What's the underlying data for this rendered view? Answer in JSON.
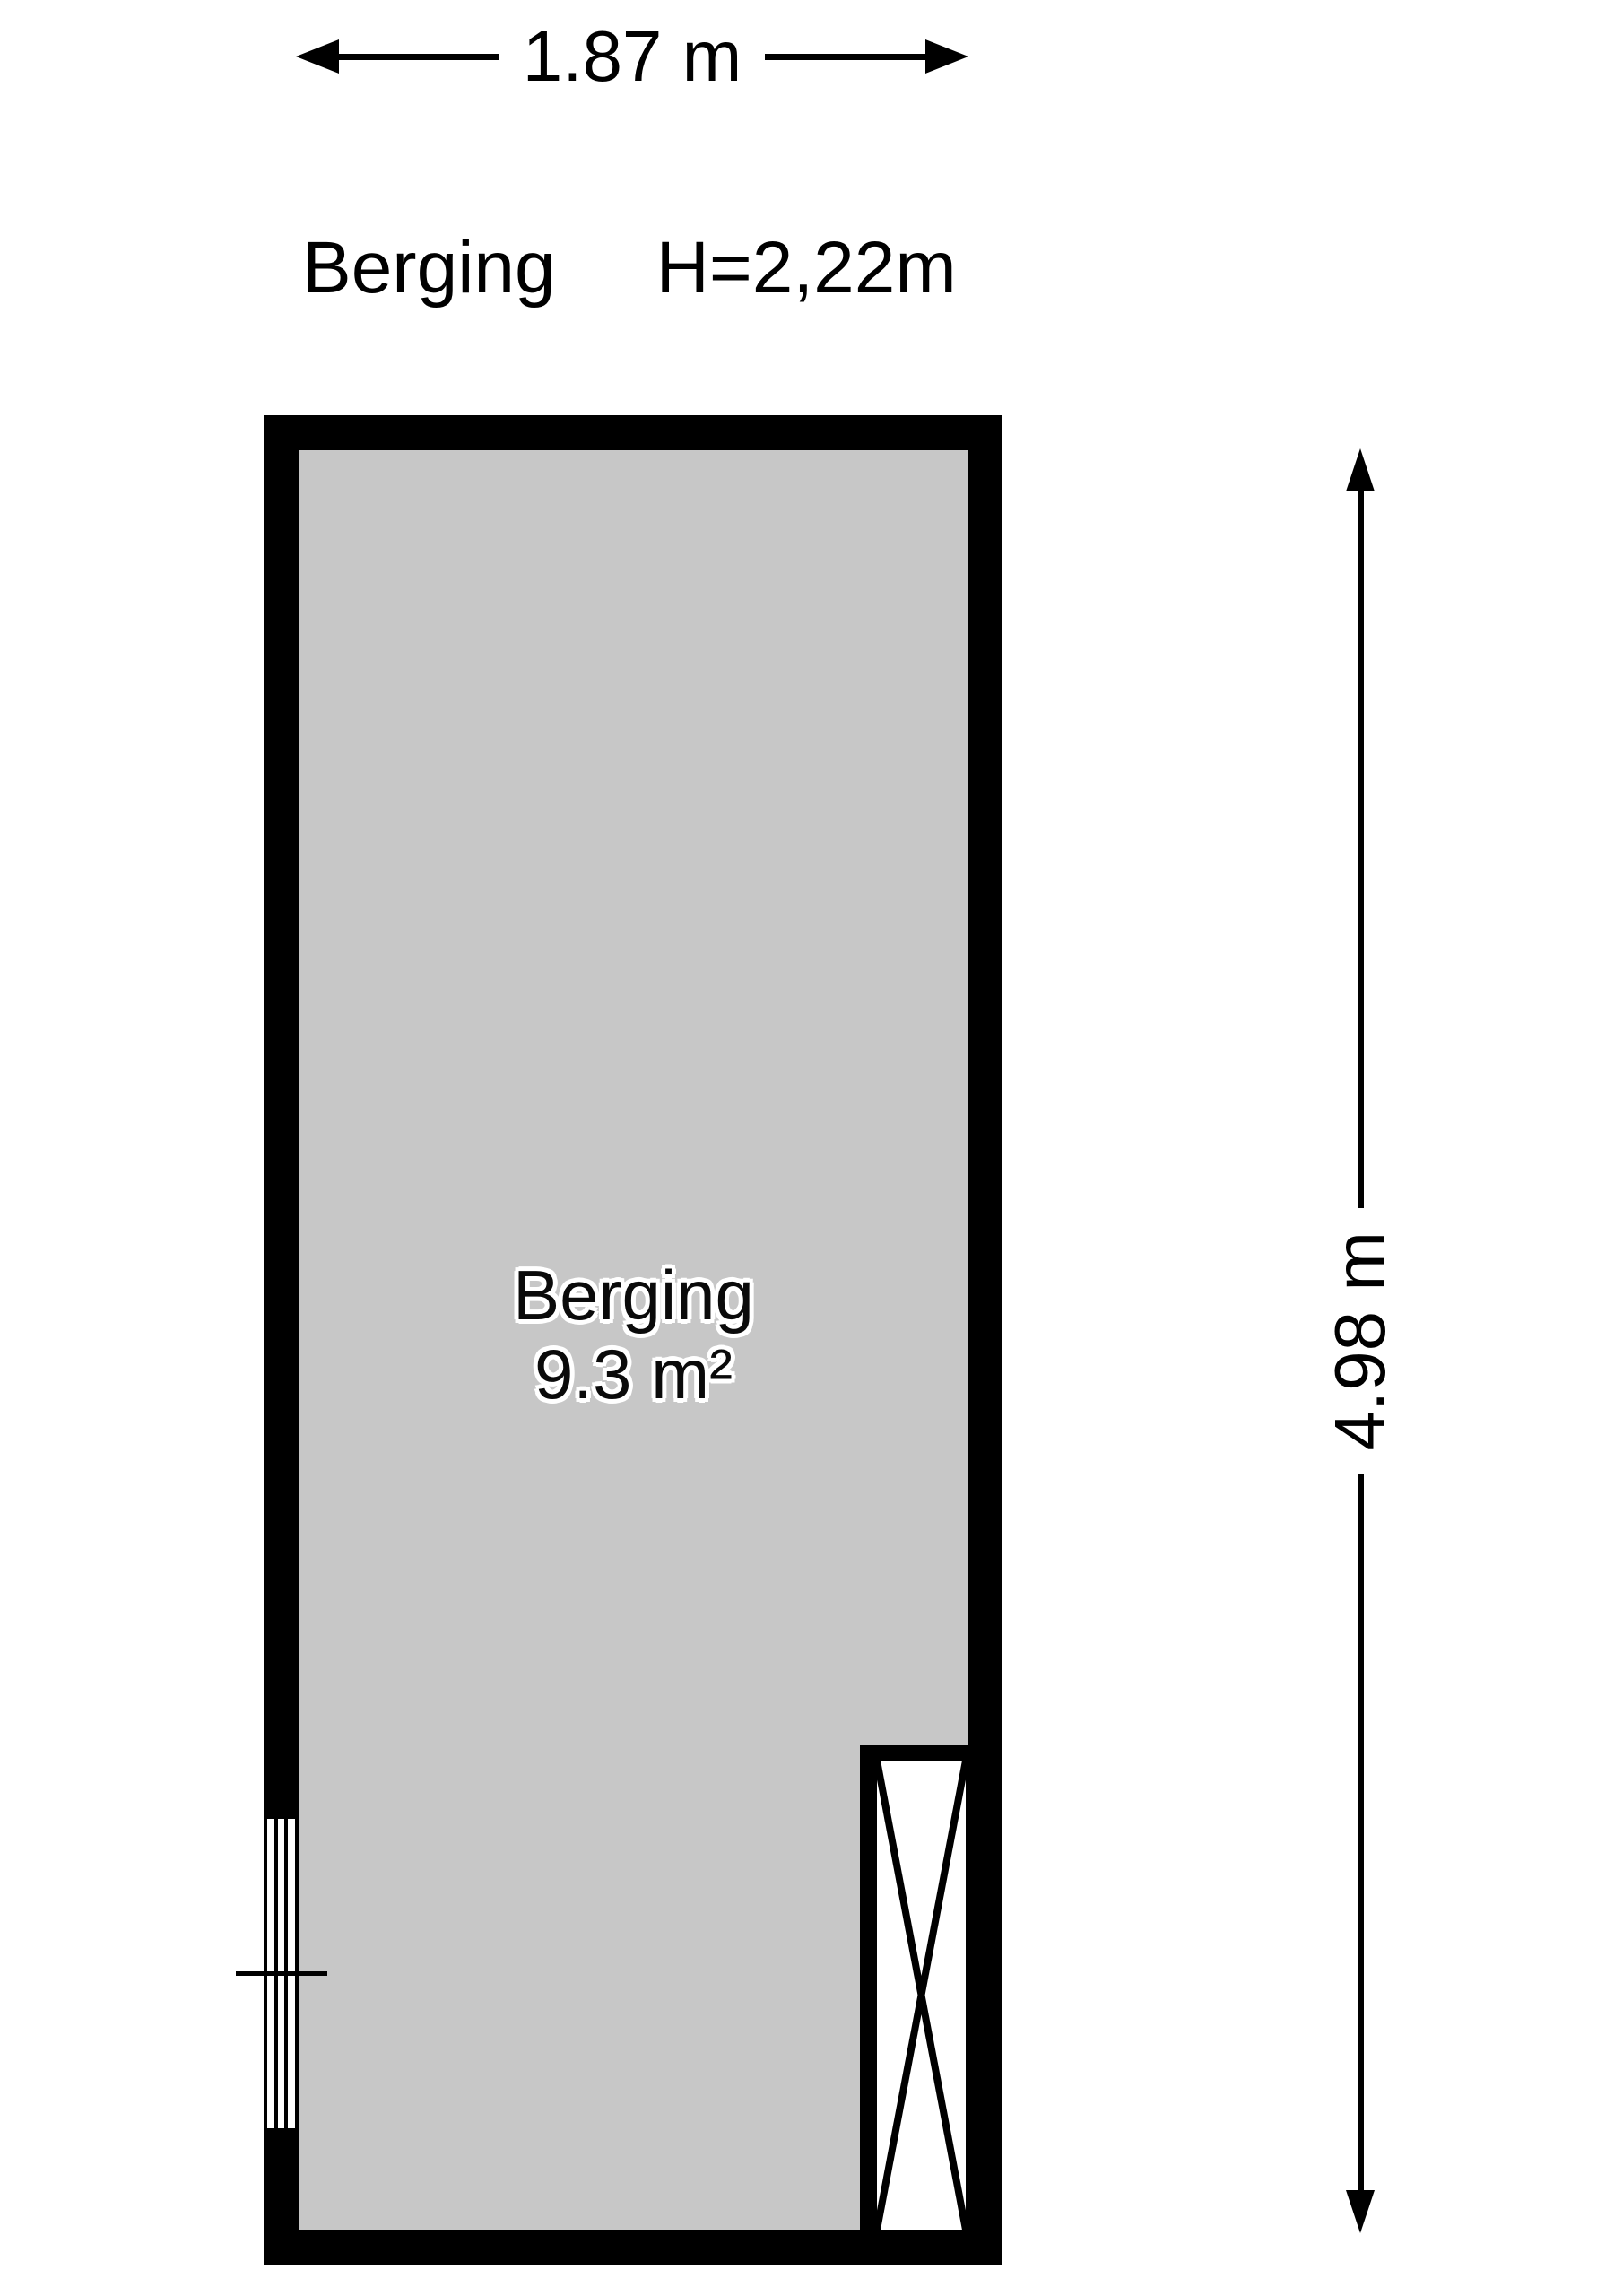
{
  "header": {
    "room_name": "Berging",
    "ceiling_height": "H=2,22m"
  },
  "dimensions": {
    "width": {
      "label": "1.87 m"
    },
    "height": {
      "label": "4.98 m"
    }
  },
  "room": {
    "name": "Berging",
    "area": "9.3 m²"
  },
  "colors": {
    "wall": "#000000",
    "floor": "#c7c7c7",
    "background": "#ffffff",
    "text": "#000000"
  },
  "features": {
    "window_icon": "window-glazing-4-lines",
    "shaft_icon": "shaft-cross-box"
  }
}
